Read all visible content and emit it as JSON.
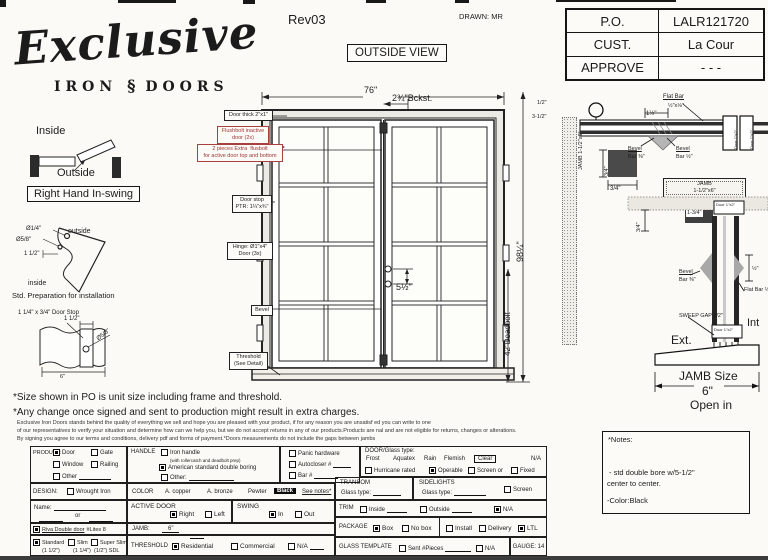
{
  "colors": {
    "ink": "#1b1b1b",
    "red_label": "#9c3434",
    "paper": "#fbfaf6"
  },
  "header": {
    "logo_main": "Exclusive",
    "logo_iron": "IRON",
    "logo_orn": "§",
    "logo_doors": "DOORS",
    "rev": "Rev03",
    "drawn": "DRAWN: MR",
    "view": "OUTSIDE VIEW"
  },
  "po": {
    "rows": [
      {
        "label": "P.O.",
        "value": "LALR121720"
      },
      {
        "label": "CUST.",
        "value": "La Cour"
      },
      {
        "label": "APPROVE",
        "value": "- - -"
      }
    ]
  },
  "swing": {
    "inside": "Inside",
    "outside": "Outside",
    "handing": "Right Hand In-swing"
  },
  "bracket": {
    "d1": "Ø1/4\"",
    "side_out": "outside",
    "d2": "Ø5/8\"",
    "dim": "1 1/2\"",
    "side_in": "inside",
    "caption": "Std. Preparation for installation"
  },
  "doorstop": {
    "title": "1 1/4\" x 3/4\"\nDoor Stop",
    "dim1": "1 1/2\"",
    "dia": "Ø5/8\"",
    "width": "6\""
  },
  "drawing": {
    "dims": {
      "width": "76\"",
      "backset": "2¾\"Bckst.",
      "height": "98¼\"",
      "deadbolt": "42\"Deadbolt",
      "bore": "5½\"",
      "half": "1/2\"",
      "threehalf": "3-1/2\""
    },
    "labels": {
      "thick": "Door thick 2\"x1\"",
      "flushbolt": "Flushbolt inactive\ndoor (2x)",
      "extra": "2 pieces Extra  flusbolt\nfor active door top and bottom",
      "stop": "Door stop\nPTR: 1¼\"x¾\"",
      "hinge": "Hinge: Ø1\"x4\"\nDoor (3x)",
      "bevel": "Bevel",
      "threshold": "Threshold\n(See Detail)"
    }
  },
  "plan": {
    "jamb_vert": "JAMB\n1-1/2\"x6\"",
    "flat1": "Flat Bar",
    "flat2": "½\"x⅛\"",
    "gap": "1½\"",
    "bev1a": "Bevel",
    "bev1b": "Bar ⅜\"",
    "bev2a": "Bevel",
    "bev2b": "Bar ½\"",
    "v34": "3/4\"",
    "h34": "3/4\"",
    "jamb_box": "JAMB\n1-1/2\"x6\"",
    "door_a": "Door 1\"x2\"",
    "door_b": "Door 1\"x2\""
  },
  "section": {
    "v34": "3/4\"",
    "d134": "1-3/4\"",
    "door_top": "Door 1\"x2\"",
    "door_bottom": "Door 1\"x2\"",
    "half": "½\"",
    "beva": "Bevel",
    "bevb": "Bar ⅜\"",
    "flat": "Flat Bar\n½\"x⅛\"",
    "sweep": "SWEEP\nGAP 1/2\"",
    "ext": "Ext.",
    "int": "Int",
    "jamb_size_label": "JAMB Size",
    "jamb_size_val": "6\"",
    "jamb_size_open": "Open in"
  },
  "notes": {
    "line1": "*Size shown in PO is unit size including frame and threshold.",
    "line2": "*Any change once signed and sent to production might result in extra charges.",
    "fine1": "Exclusive Iron Doors stands behind the quality of everything we sell and hope you are pleased with your product, if for any reason you are unsatisf ed you can write to one",
    "fine2": "of our representatives to verify your situation and determine how can we help you, but we do not accept returns in any of our products.Products are  nal and are not eligible for returns, changes or alterations.",
    "fine3": "By signing you agree to our terms and conditions, delivery pdf and forms of payment.*Doors measurements do not include the gaps between jambs"
  },
  "notes_box": {
    "title": "*Notes:",
    "l1": "-  std double bore w/5-1/2\"",
    "l2": "center to center.",
    "l3": "-Color:Black"
  },
  "form": {
    "product": {
      "label": "PRODUCT:",
      "door": "Door",
      "door_on": true,
      "gate": "Gate",
      "gate_on": false,
      "window": "Window",
      "window_on": false,
      "railing": "Railing",
      "railing_on": false,
      "other": "Other",
      "other_on": false
    },
    "handle": {
      "label": "HANDLE",
      "iron": "Iron handle",
      "iron_on": false,
      "iron_sub": "(with rollercatch and deadbolt prep)",
      "american": "American standard double boring",
      "american_on": true,
      "other": "Other:",
      "other_on": false
    },
    "hardware": {
      "panic": "Panic hardware",
      "panic_on": false,
      "autocloser": "Autocloser #",
      "autocloser_on": false,
      "bar": "Bar #",
      "bar_on": false
    },
    "glass": {
      "label": "DOOR/Glass type:",
      "frost": "Frost",
      "aquatex": "Aquatex",
      "rain": "Rain",
      "flemish": "Flemish",
      "clear": "Clear",
      "na": "N/A",
      "hurricane": "Hurricane rated",
      "hurricane_on": false,
      "operable": "Operable",
      "operable_on": true,
      "screen": "Screen or",
      "screen_on": false,
      "fixed": "Fixed",
      "fixed_on": false
    },
    "design": {
      "label": "DESIGN:",
      "wrought": "Wrought Iron",
      "wrought_on": false
    },
    "name": {
      "label": "Name:",
      "or": "or"
    },
    "riva": {
      "on": true,
      "name": "Riva Double door",
      "lites": "#Lites 8"
    },
    "profile": {
      "standard": "Standard",
      "standard_sub": "(1 1/2\")",
      "standard_on": true,
      "slim": "Slim",
      "slim_sub": "(1 1/4\")",
      "slim_on": false,
      "super": "Super Slim",
      "super_sub": "(1/2\") SDL",
      "super_on": false
    },
    "color": {
      "label": "COLOR",
      "c1": "A. copper",
      "c2": "A. bronze",
      "c3": "Pewter",
      "selected": "Black",
      "see": "See notes*"
    },
    "active": {
      "label": "ACTIVE DOOR",
      "right": "Right",
      "right_on": true,
      "left": "Left",
      "left_on": false
    },
    "swing": {
      "label": "SWING",
      "in": "In",
      "in_on": true,
      "out": "Out",
      "out_on": false
    },
    "jamb": {
      "label": "JAMB:",
      "value": "6\""
    },
    "threshold": {
      "label": "THRESHOLD",
      "res": "Residential",
      "res_on": true,
      "com": "Commercial",
      "com_on": false,
      "na": "N/A",
      "na_on": false
    },
    "transom": {
      "label": "TRANSOM",
      "glass": "Glass type:"
    },
    "sidelights": {
      "label": "SIDELIGHTS",
      "glass": "Glass type:",
      "screen": "Screen",
      "screen_on": false
    },
    "trim": {
      "label": "TRIM",
      "inside": "Inside",
      "inside_on": false,
      "outside": "Outside",
      "outside_on": false,
      "na": "N/A",
      "na_on": true
    },
    "package": {
      "label": "PACKAGE",
      "box": "Box",
      "box_on": true,
      "nobox": "No box",
      "nobox_on": false,
      "install": "Install",
      "install_on": false,
      "delivery": "Delivery",
      "delivery_on": false,
      "ltl": "LTL",
      "ltl_on": true
    },
    "template": {
      "label": "GLASS TEMPLATE",
      "sent": "Sent #Pieces",
      "sent_on": false,
      "na": "N/A",
      "na_on": false,
      "gauge": "GAUGE: 14"
    }
  }
}
